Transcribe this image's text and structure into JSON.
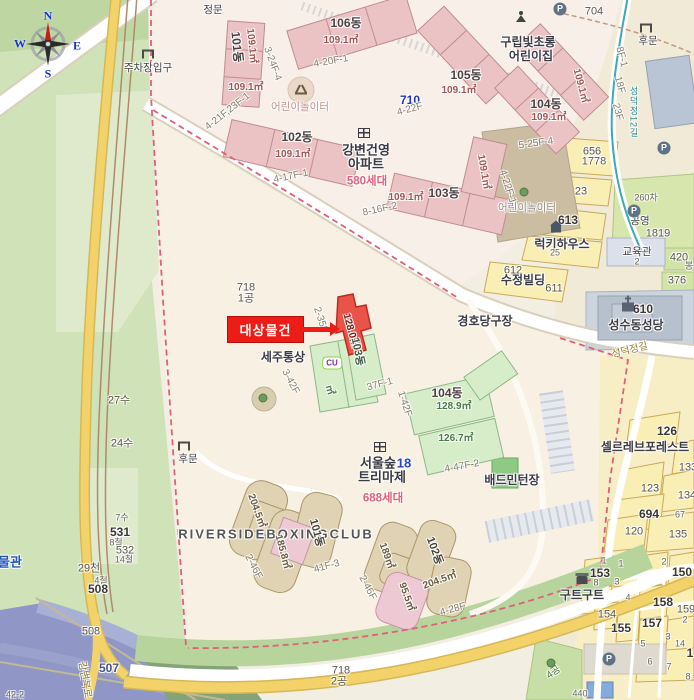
{
  "compass": {
    "n": "N",
    "e": "E",
    "s": "S",
    "w": "W"
  },
  "target": {
    "label": "대상물건"
  },
  "colors": {
    "target_red": "#ee1c16",
    "apartment_pink": "#ecc3c4",
    "green_building": "#d7edca",
    "tan_building": "#e0d3b4",
    "parcel_yellow": "#f9efb5",
    "park_green": "#cfe2b8",
    "river_blue": "#9097c6",
    "road_yellow": "#f3d369",
    "boundary_dash_pink": "#e0607a",
    "compass_letter_blue": "#1733cc",
    "household_pink": "#e0607a"
  },
  "map": {
    "labels": [
      {
        "t": "주차장입구",
        "x": 148,
        "y": 68,
        "c": "poi-s",
        "n": "parking-entrance-label"
      },
      {
        "t": "정문",
        "x": 213,
        "y": 10,
        "c": "poi-s",
        "n": "main-gate-label"
      },
      {
        "t": "101동",
        "x": 237,
        "y": 47,
        "r": 84,
        "c": "dong"
      },
      {
        "t": "109.1㎡",
        "x": 251,
        "y": 46,
        "r": 84,
        "c": "area-p"
      },
      {
        "t": "3-24F-4",
        "x": 272,
        "y": 64,
        "r": 70,
        "c": "lot"
      },
      {
        "t": "109.1㎡",
        "x": 246,
        "y": 88,
        "c": "area-p"
      },
      {
        "t": "106동",
        "x": 346,
        "y": 23,
        "c": "dong"
      },
      {
        "t": "109.1㎡",
        "x": 341,
        "y": 41,
        "c": "area-p"
      },
      {
        "t": "4-20F-1",
        "x": 331,
        "y": 62,
        "r": -10,
        "c": "lot"
      },
      {
        "t": "어린이놀이터",
        "x": 300,
        "y": 107,
        "c": "play",
        "n": "playground-label"
      },
      {
        "t": "710",
        "x": 410,
        "y": 100,
        "c": "blue-num"
      },
      {
        "t": "4-22F",
        "x": 410,
        "y": 110,
        "r": -15,
        "c": "lot"
      },
      {
        "t": "105동",
        "x": 466,
        "y": 75,
        "c": "dong"
      },
      {
        "t": "109.1㎡",
        "x": 459,
        "y": 91,
        "c": "area-p"
      },
      {
        "t": "구립빛초롱",
        "x": 528,
        "y": 42,
        "c": "poi",
        "n": "daycare-name"
      },
      {
        "t": "어린이집",
        "x": 531,
        "y": 56,
        "c": "poi",
        "n": "daycare-name"
      },
      {
        "t": "704",
        "x": 594,
        "y": 12,
        "c": "lot-num"
      },
      {
        "t": "후문",
        "x": 648,
        "y": 41,
        "c": "poi-s",
        "n": "back-gate-label"
      },
      {
        "t": "104동",
        "x": 546,
        "y": 104,
        "c": "dong"
      },
      {
        "t": "109.1㎡",
        "x": 549,
        "y": 118,
        "c": "area-p"
      },
      {
        "t": "109.1㎡",
        "x": 580,
        "y": 86,
        "r": 75,
        "c": "area-p"
      },
      {
        "t": "8F-1",
        "x": 621,
        "y": 57,
        "r": 75,
        "c": "lot"
      },
      {
        "t": "18F",
        "x": 619,
        "y": 85,
        "r": 75,
        "c": "lot"
      },
      {
        "t": "23F",
        "x": 617,
        "y": 112,
        "r": 75,
        "c": "lot"
      },
      {
        "t": "성덕정12길",
        "x": 633,
        "y": 112,
        "c": "road-v",
        "n": "street-name"
      },
      {
        "t": "102동",
        "x": 297,
        "y": 137,
        "c": "dong"
      },
      {
        "t": "109.1㎡",
        "x": 293,
        "y": 155,
        "c": "area-p"
      },
      {
        "t": "4-21F,23F-1",
        "x": 228,
        "y": 112,
        "r": -38,
        "c": "lot"
      },
      {
        "t": "4-17F-1",
        "x": 291,
        "y": 177,
        "r": -12,
        "c": "lot"
      },
      {
        "t": "강변건영",
        "x": 366,
        "y": 150,
        "c": "apt",
        "n": "apartment-name"
      },
      {
        "t": "아파트",
        "x": 366,
        "y": 164,
        "c": "apt",
        "n": "apartment-name"
      },
      {
        "t": "580세대",
        "x": 367,
        "y": 182,
        "c": "sedae",
        "n": "household-count"
      },
      {
        "t": "8-16F-2",
        "x": 380,
        "y": 210,
        "r": -12,
        "c": "lot"
      },
      {
        "t": "103동",
        "x": 444,
        "y": 193,
        "c": "dong"
      },
      {
        "t": "109.1㎡",
        "x": 406,
        "y": 198,
        "c": "area-p"
      },
      {
        "t": "109.1㎡",
        "x": 483,
        "y": 172,
        "r": 80,
        "c": "area-p"
      },
      {
        "t": "5-25F-4",
        "x": 536,
        "y": 144,
        "r": -8,
        "c": "lot"
      },
      {
        "t": "4-22F-1",
        "x": 507,
        "y": 187,
        "r": 72,
        "c": "lot"
      },
      {
        "t": "어린이놀이터",
        "x": 527,
        "y": 208,
        "c": "play-g",
        "n": "playground-label"
      },
      {
        "t": "656",
        "x": 592,
        "y": 152,
        "c": "lot-num"
      },
      {
        "t": "1778",
        "x": 594,
        "y": 162,
        "c": "lot-num"
      },
      {
        "t": "23",
        "x": 581,
        "y": 192,
        "c": "lot-num"
      },
      {
        "t": "613",
        "x": 568,
        "y": 220,
        "c": "lot-num-b"
      },
      {
        "t": "럭키하우스",
        "x": 562,
        "y": 244,
        "c": "poi",
        "n": "building-name"
      },
      {
        "t": "25",
        "x": 555,
        "y": 253,
        "c": "lot-sm"
      },
      {
        "t": "612",
        "x": 513,
        "y": 271,
        "c": "lot-num"
      },
      {
        "t": "수정빌딩",
        "x": 523,
        "y": 280,
        "c": "poi",
        "n": "building-name"
      },
      {
        "t": "611",
        "x": 554,
        "y": 289,
        "c": "lot-num"
      },
      {
        "t": "260차",
        "x": 646,
        "y": 198,
        "c": "lot-sm"
      },
      {
        "t": "공영",
        "x": 640,
        "y": 221,
        "c": "poi-s"
      },
      {
        "t": "1819",
        "x": 658,
        "y": 234,
        "c": "lot-num"
      },
      {
        "t": "교육관",
        "x": 637,
        "y": 252,
        "c": "poi-s",
        "n": "building-name"
      },
      {
        "t": "2",
        "x": 637,
        "y": 262,
        "c": "lot-sm"
      },
      {
        "t": "420",
        "x": 679,
        "y": 258,
        "c": "lot-num"
      },
      {
        "t": "봉",
        "x": 689,
        "y": 266,
        "c": "lot-sm"
      },
      {
        "t": "376",
        "x": 677,
        "y": 281,
        "c": "lot-num"
      },
      {
        "t": "610",
        "x": 643,
        "y": 309,
        "c": "lot-num-b"
      },
      {
        "t": "성수동성당",
        "x": 636,
        "y": 325,
        "c": "poi",
        "n": "church-name"
      },
      {
        "t": "성덕정길",
        "x": 630,
        "y": 351,
        "r": -14,
        "c": "road",
        "n": "street-name"
      },
      {
        "t": "경호당구장",
        "x": 485,
        "y": 321,
        "c": "poi",
        "n": "business-name"
      },
      {
        "t": "718",
        "x": 246,
        "y": 288,
        "c": "lot-num"
      },
      {
        "t": "1공",
        "x": 246,
        "y": 299,
        "c": "lot-num"
      },
      {
        "t": "2-35F",
        "x": 320,
        "y": 320,
        "r": 72,
        "c": "lot"
      },
      {
        "t": "128.0㎡",
        "x": 350,
        "y": 331,
        "r": 75,
        "c": "area-r",
        "n": "target-area"
      },
      {
        "t": "103동",
        "x": 357,
        "y": 352,
        "r": 78,
        "c": "dong-g"
      },
      {
        "t": "세주통상",
        "x": 283,
        "y": 357,
        "c": "poi",
        "n": "business-name"
      },
      {
        "t": "㎡",
        "x": 329,
        "y": 390,
        "r": 75,
        "c": "area-g"
      },
      {
        "t": "3-42F",
        "x": 290,
        "y": 382,
        "r": 62,
        "c": "lot"
      },
      {
        "t": "37F-1",
        "x": 380,
        "y": 385,
        "r": -15,
        "c": "lot"
      },
      {
        "t": "1-42F",
        "x": 404,
        "y": 404,
        "r": 72,
        "c": "lot"
      },
      {
        "t": "104동",
        "x": 447,
        "y": 393,
        "c": "dong"
      },
      {
        "t": "128.9㎡",
        "x": 454,
        "y": 407,
        "c": "area-g"
      },
      {
        "t": "126.7㎡",
        "x": 456,
        "y": 439,
        "c": "area-g"
      },
      {
        "t": "4-47F-2",
        "x": 462,
        "y": 467,
        "r": -10,
        "c": "lot"
      },
      {
        "t": "서울숲",
        "x": 378,
        "y": 463,
        "c": "apt",
        "n": "apartment-name"
      },
      {
        "t": "18",
        "x": 404,
        "y": 463,
        "c": "apt-blue"
      },
      {
        "t": "트리마제",
        "x": 382,
        "y": 477,
        "c": "apt",
        "n": "apartment-name"
      },
      {
        "t": "688세대",
        "x": 383,
        "y": 499,
        "c": "sedae",
        "n": "household-count"
      },
      {
        "t": "배드민턴장",
        "x": 512,
        "y": 480,
        "c": "poi",
        "n": "badminton-court-label"
      },
      {
        "t": "후문",
        "x": 188,
        "y": 459,
        "c": "poi-s",
        "n": "back-gate-label"
      },
      {
        "t": "RIVERSIDEBOXINGCLUB",
        "x": 276,
        "y": 534,
        "c": "eng",
        "n": "business-name"
      },
      {
        "t": "204.5㎡",
        "x": 256,
        "y": 511,
        "r": 70,
        "c": "area-t"
      },
      {
        "t": "185.8㎡",
        "x": 282,
        "y": 552,
        "r": 75,
        "c": "area-t"
      },
      {
        "t": "101동",
        "x": 316,
        "y": 533,
        "r": 75,
        "c": "dong-t"
      },
      {
        "t": "2-46F",
        "x": 253,
        "y": 567,
        "r": 62,
        "c": "lot"
      },
      {
        "t": "41F-3",
        "x": 327,
        "y": 567,
        "r": -15,
        "c": "lot"
      },
      {
        "t": "2-46F",
        "x": 367,
        "y": 588,
        "r": 62,
        "c": "lot"
      },
      {
        "t": "189㎡",
        "x": 386,
        "y": 556,
        "r": 70,
        "c": "area-t"
      },
      {
        "t": "102동",
        "x": 434,
        "y": 551,
        "r": 70,
        "c": "dong-t"
      },
      {
        "t": "204.5㎡",
        "x": 440,
        "y": 581,
        "r": -20,
        "c": "area-t"
      },
      {
        "t": "95.5㎡",
        "x": 406,
        "y": 597,
        "r": 70,
        "c": "area-t"
      },
      {
        "t": "4-28F",
        "x": 453,
        "y": 610,
        "r": -15,
        "c": "lot"
      },
      {
        "t": "718",
        "x": 341,
        "y": 671,
        "c": "lot-num"
      },
      {
        "t": "2공",
        "x": 339,
        "y": 682,
        "c": "lot-num"
      },
      {
        "t": "물관",
        "x": 10,
        "y": 562,
        "c": "poi-blue",
        "n": "museum-label"
      },
      {
        "t": "27수",
        "x": 119,
        "y": 401,
        "c": "lot-num"
      },
      {
        "t": "24수",
        "x": 122,
        "y": 444,
        "c": "lot-num"
      },
      {
        "t": "7수",
        "x": 122,
        "y": 518,
        "c": "lot-sm"
      },
      {
        "t": "531",
        "x": 120,
        "y": 532,
        "c": "lot-num-b"
      },
      {
        "t": "8철",
        "x": 116,
        "y": 543,
        "c": "lot-sm"
      },
      {
        "t": "532",
        "x": 125,
        "y": 551,
        "c": "lot-num"
      },
      {
        "t": "14철",
        "x": 124,
        "y": 560,
        "c": "lot-sm"
      },
      {
        "t": "29천",
        "x": 89,
        "y": 569,
        "c": "lot-num"
      },
      {
        "t": "4철",
        "x": 101,
        "y": 581,
        "c": "lot-sm"
      },
      {
        "t": "508",
        "x": 98,
        "y": 589,
        "c": "lot-num-b"
      },
      {
        "t": "508",
        "x": 91,
        "y": 632,
        "c": "lot-num"
      },
      {
        "t": "507",
        "x": 109,
        "y": 668,
        "c": "water-num"
      },
      {
        "t": "강변북로",
        "x": 84,
        "y": 680,
        "r": 80,
        "c": "road",
        "n": "street-name"
      },
      {
        "t": "42-2",
        "x": 15,
        "y": 695,
        "c": "lot-sm"
      },
      {
        "t": "126",
        "x": 667,
        "y": 431,
        "c": "lot-num-b"
      },
      {
        "t": "셀르레브포레스트",
        "x": 645,
        "y": 447,
        "c": "poi",
        "n": "building-name"
      },
      {
        "t": "133",
        "x": 688,
        "y": 468,
        "c": "lot-num"
      },
      {
        "t": "123",
        "x": 650,
        "y": 489,
        "c": "lot-num"
      },
      {
        "t": "134",
        "x": 687,
        "y": 496,
        "c": "lot-num"
      },
      {
        "t": "694",
        "x": 649,
        "y": 514,
        "c": "lot-num-b"
      },
      {
        "t": "67",
        "x": 680,
        "y": 515,
        "c": "lot-sm"
      },
      {
        "t": "120",
        "x": 634,
        "y": 532,
        "c": "lot-num"
      },
      {
        "t": "135",
        "x": 678,
        "y": 535,
        "c": "lot-num"
      },
      {
        "t": "153",
        "x": 600,
        "y": 573,
        "c": "lot-num-b"
      },
      {
        "t": "1",
        "x": 604,
        "y": 561,
        "c": "lot-sm"
      },
      {
        "t": "1",
        "x": 621,
        "y": 564,
        "c": "lot-sm"
      },
      {
        "t": "2",
        "x": 664,
        "y": 562,
        "c": "lot-sm"
      },
      {
        "t": "150",
        "x": 682,
        "y": 572,
        "c": "lot-num-b"
      },
      {
        "t": "8",
        "x": 596,
        "y": 583,
        "c": "lot-sm"
      },
      {
        "t": "3",
        "x": 617,
        "y": 582,
        "c": "lot-sm"
      },
      {
        "t": "구트구트",
        "x": 582,
        "y": 595,
        "c": "poi",
        "n": "business-name"
      },
      {
        "t": "4",
        "x": 628,
        "y": 598,
        "c": "lot-sm"
      },
      {
        "t": "158",
        "x": 663,
        "y": 602,
        "c": "lot-num-b"
      },
      {
        "t": "159",
        "x": 686,
        "y": 610,
        "c": "lot-num"
      },
      {
        "t": "2",
        "x": 685,
        "y": 620,
        "c": "lot-sm"
      },
      {
        "t": "154",
        "x": 607,
        "y": 615,
        "c": "lot-num"
      },
      {
        "t": "155",
        "x": 621,
        "y": 628,
        "c": "lot-num-b"
      },
      {
        "t": "157",
        "x": 652,
        "y": 623,
        "c": "lot-num-b"
      },
      {
        "t": "3",
        "x": 668,
        "y": 637,
        "c": "lot-sm"
      },
      {
        "t": "14",
        "x": 680,
        "y": 644,
        "c": "lot-sm"
      },
      {
        "t": "5",
        "x": 643,
        "y": 644,
        "c": "lot-sm"
      },
      {
        "t": "1",
        "x": 690,
        "y": 653,
        "c": "lot-num-b"
      },
      {
        "t": "6",
        "x": 650,
        "y": 662,
        "c": "lot-sm"
      },
      {
        "t": "7",
        "x": 669,
        "y": 667,
        "c": "lot-sm"
      },
      {
        "t": "8",
        "x": 688,
        "y": 677,
        "c": "lot-sm"
      },
      {
        "t": "4공",
        "x": 554,
        "y": 673,
        "r": -35,
        "c": "lot-g"
      },
      {
        "t": "440",
        "x": 580,
        "y": 694,
        "c": "lot-sm"
      }
    ],
    "icons": [
      {
        "kind": "p",
        "glyph": "P",
        "x": 560,
        "y": 9
      },
      {
        "kind": "p",
        "glyph": "P",
        "x": 664,
        "y": 148
      },
      {
        "kind": "p",
        "glyph": "P",
        "x": 634,
        "y": 211
      },
      {
        "kind": "p",
        "glyph": "P",
        "x": 609,
        "y": 659
      },
      {
        "kind": "gate",
        "x": 148,
        "y": 54
      },
      {
        "kind": "gate",
        "x": 646,
        "y": 28
      },
      {
        "kind": "gate",
        "x": 184,
        "y": 446
      },
      {
        "kind": "apt",
        "x": 364,
        "y": 133
      },
      {
        "kind": "apt",
        "x": 380,
        "y": 447
      },
      {
        "kind": "child",
        "x": 521,
        "y": 17
      },
      {
        "kind": "play",
        "x": 301,
        "y": 90
      },
      {
        "kind": "church",
        "x": 628,
        "y": 307
      },
      {
        "kind": "shop",
        "x": 582,
        "y": 580
      },
      {
        "kind": "house",
        "x": 556,
        "y": 229
      },
      {
        "kind": "cu",
        "glyph": "CU",
        "x": 332,
        "y": 363
      },
      {
        "kind": "tree",
        "x": 524,
        "y": 192
      },
      {
        "kind": "tree",
        "x": 263,
        "y": 398
      },
      {
        "kind": "tree",
        "x": 551,
        "y": 663
      }
    ]
  }
}
